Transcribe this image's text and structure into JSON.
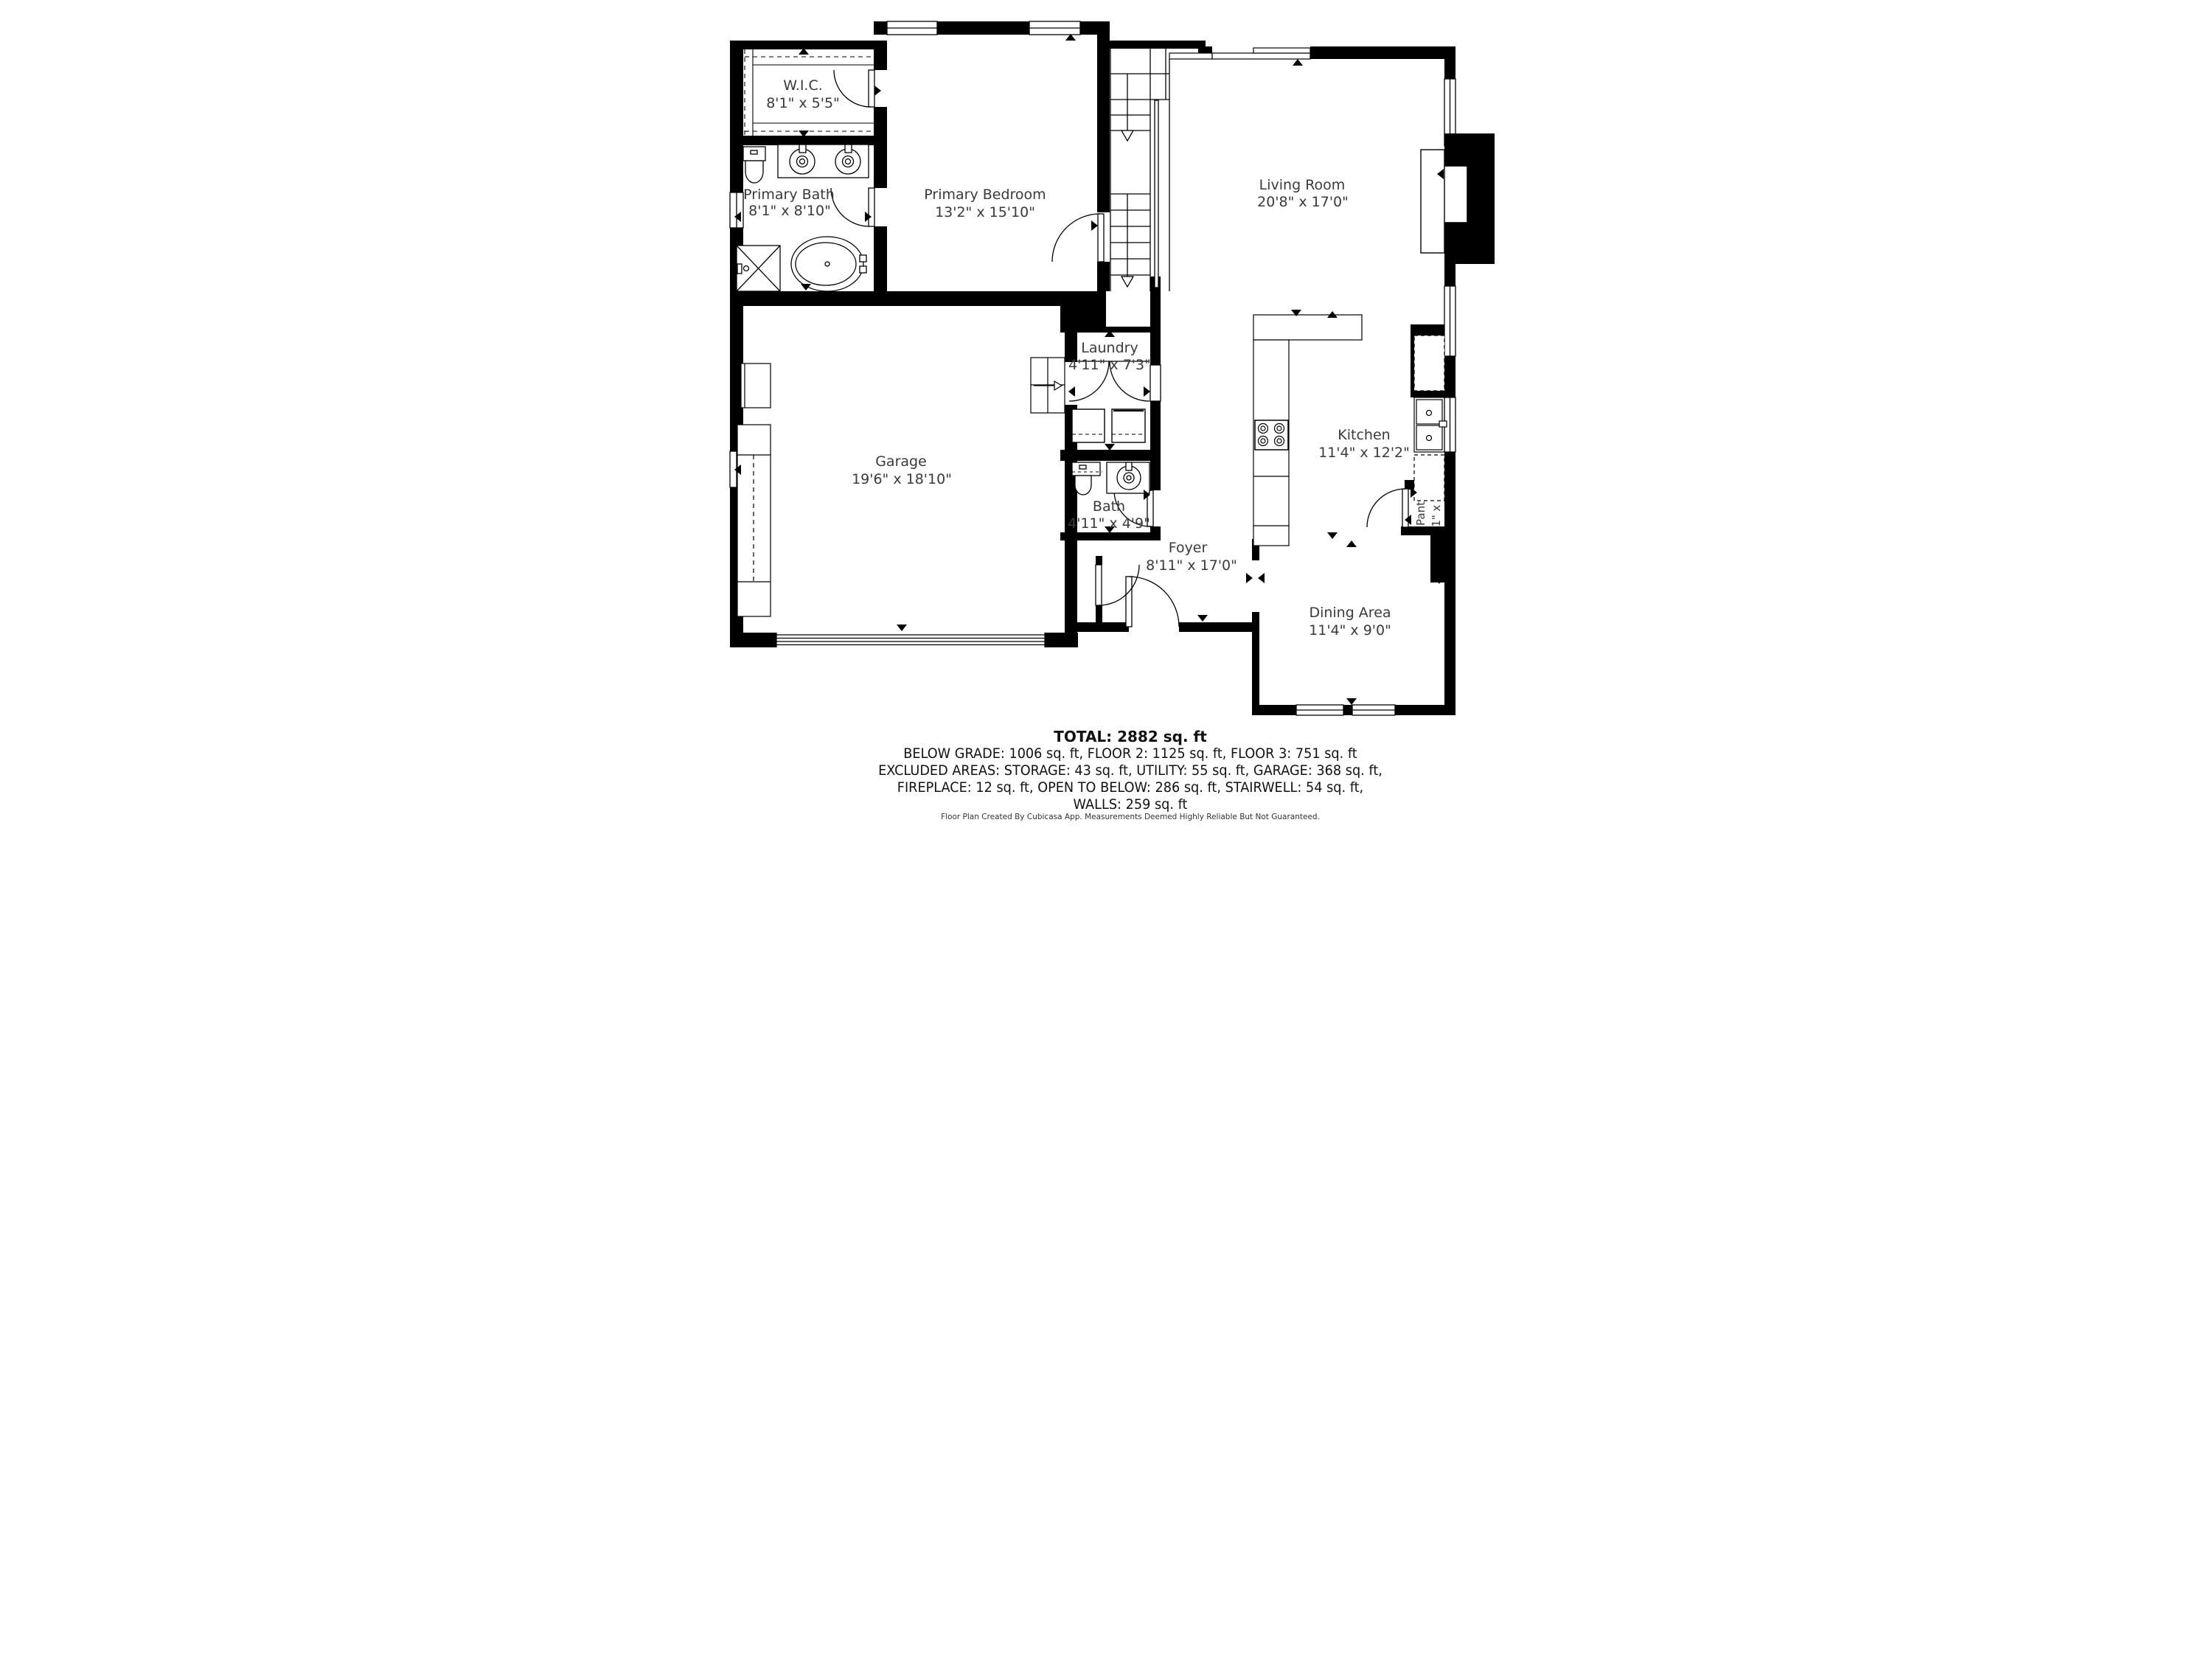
{
  "rooms": {
    "wic": {
      "name": "W.I.C.",
      "dims": "8'1\" x 5'5\""
    },
    "primary_bedroom": {
      "name": "Primary Bedroom",
      "dims": "13'2\" x 15'10\""
    },
    "primary_bath": {
      "name": "Primary Bath",
      "dims": "8'1\" x 8'10\""
    },
    "living_room": {
      "name": "Living Room",
      "dims": "20'8\" x 17'0\""
    },
    "laundry": {
      "name": "Laundry",
      "dims": "4'11\" x 7'3\""
    },
    "garage": {
      "name": "Garage",
      "dims": "19'6\" x 18'10\""
    },
    "kitchen": {
      "name": "Kitchen",
      "dims": "11'4\" x 12'2\""
    },
    "bath": {
      "name": "Bath",
      "dims": "4'11\" x 4'9\""
    },
    "foyer": {
      "name": "Foyer",
      "dims": "8'11\" x 17'0\""
    },
    "dining_area": {
      "name": "Dining Area",
      "dims": "11'4\" x 9'0\""
    },
    "pantry": {
      "name": "Pantry",
      "dims": "2'1\" x 2'9\""
    }
  },
  "summary": {
    "total": "TOTAL: 2882 sq. ft",
    "line1": "BELOW GRADE: 1006 sq. ft, FLOOR 2: 1125 sq. ft, FLOOR 3: 751 sq. ft",
    "line2": "EXCLUDED AREAS: STORAGE: 43 sq. ft, UTILITY: 55 sq. ft, GARAGE: 368 sq. ft,",
    "line3": "FIREPLACE: 12 sq. ft, OPEN TO BELOW: 286 sq. ft, STAIRWELL: 54 sq. ft,",
    "line4": "WALLS: 259 sq. ft"
  },
  "footer": "Floor Plan Created By Cubicasa App. Measurements Deemed Highly Reliable But Not Guaranteed.",
  "colors": {
    "wall": "#000000",
    "label": "#3a3a3a",
    "background": "#ffffff"
  }
}
